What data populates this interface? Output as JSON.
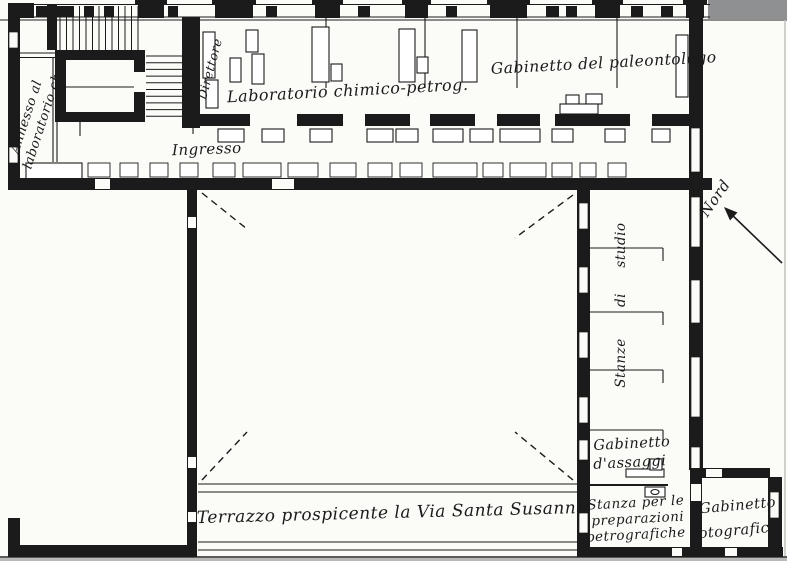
{
  "labels": {
    "annesso_line1": "Annesso al",
    "annesso_line2": "laboratorio ch.",
    "direttore": "Direttore",
    "laboratorio": "Laboratorio chimico-petrog.",
    "paleontologo": "Gabinetto del paleontologo",
    "ingresso": "Ingresso",
    "nord": "Nord",
    "stanze_word1": "Stanze",
    "stanze_word2": "di",
    "stanze_word3": "studio",
    "assaggi_line1": "Gabinetto",
    "assaggi_line2": "d'assaggi",
    "preparazioni_line1": "Stanza per le",
    "preparazioni_line2": "preparazioni",
    "preparazioni_line3": "petrografiche",
    "fotografico_line1": "Gabinetto",
    "fotografico_line2": "fotografico",
    "terrazzo": "Terrazzo prospicente la Via Santa Susanna"
  },
  "colors": {
    "ink": "#1b1b1b",
    "paper": "#fbfbf8",
    "scan_gray": "#8f9091"
  }
}
